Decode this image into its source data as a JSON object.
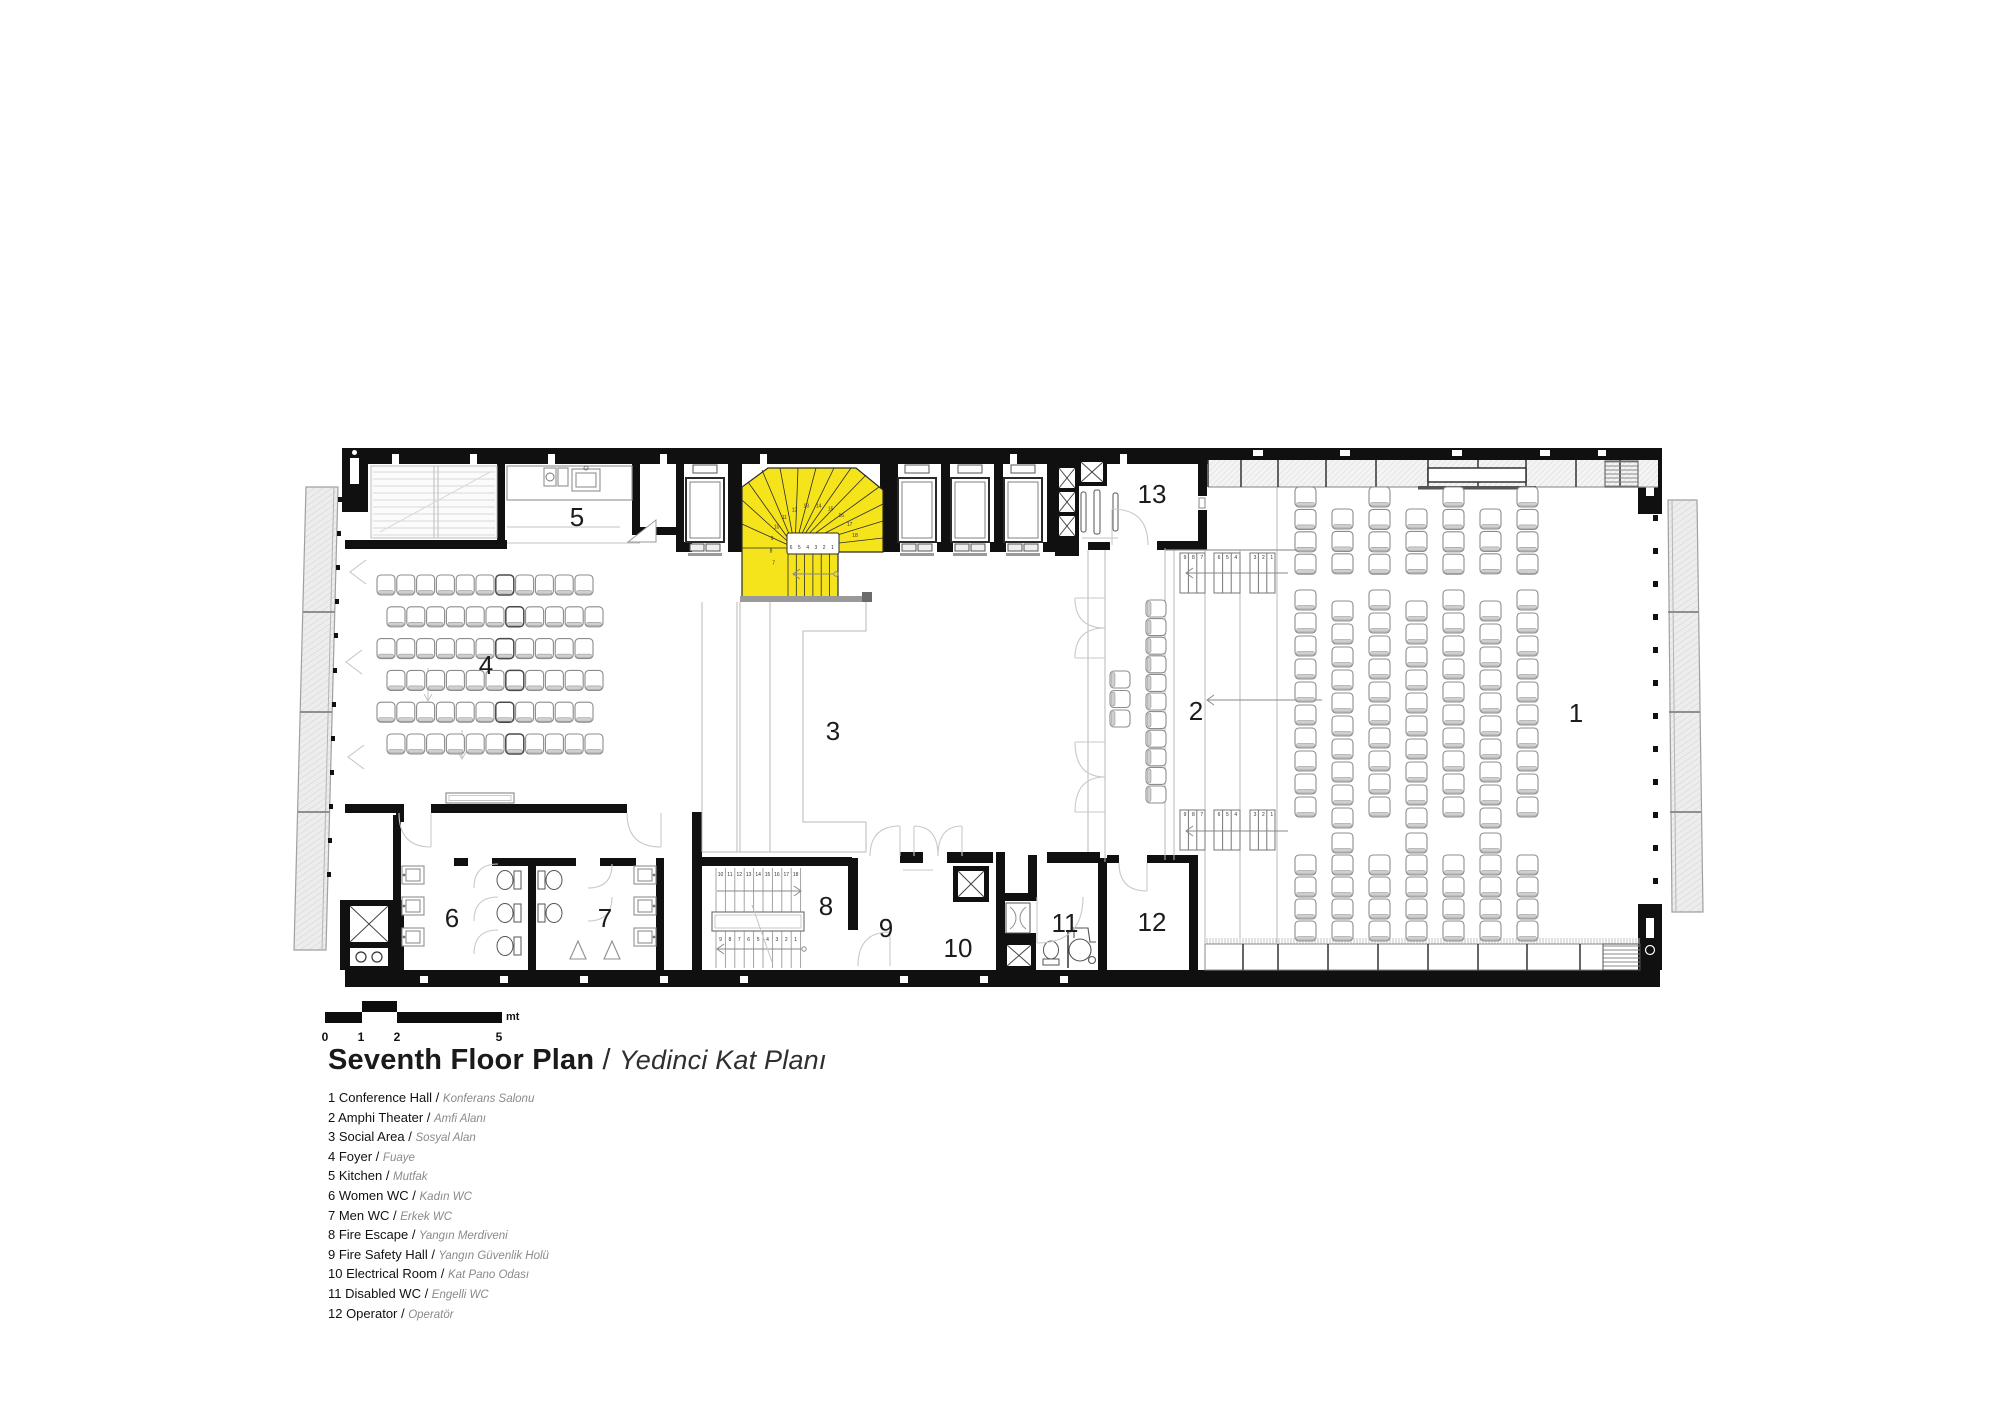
{
  "title": {
    "en": "Seventh Floor Plan",
    "sep": " / ",
    "tr": "Yedinci Kat Planı"
  },
  "legend": [
    {
      "num": "1",
      "en": "Conference Hall",
      "tr": "Konferans Salonu"
    },
    {
      "num": "2",
      "en": "Amphi Theater",
      "tr": "Amfi Alanı"
    },
    {
      "num": "3",
      "en": "Social Area",
      "tr": "Sosyal Alan"
    },
    {
      "num": "4",
      "en": "Foyer",
      "tr": "Fuaye"
    },
    {
      "num": "5",
      "en": "Kitchen",
      "tr": "Mutfak"
    },
    {
      "num": "6",
      "en": "Women WC",
      "tr": "Kadın WC"
    },
    {
      "num": "7",
      "en": "Men WC",
      "tr": "Erkek WC"
    },
    {
      "num": "8",
      "en": "Fire Escape",
      "tr": "Yangın Merdiveni"
    },
    {
      "num": "9",
      "en": "Fire Safety Hall",
      "tr": "Yangın Güvenlik Holü"
    },
    {
      "num": "10",
      "en": "Electrical Room",
      "tr": "Kat Pano Odası"
    },
    {
      "num": "11",
      "en": "Disabled WC",
      "tr": "Engelli  WC"
    },
    {
      "num": "12",
      "en": "Operator",
      "tr": "Operatör"
    }
  ],
  "scale_bar": {
    "ticks": [
      {
        "label": "0",
        "x": 0
      },
      {
        "label": "1",
        "x": 36
      },
      {
        "label": "2",
        "x": 72
      },
      {
        "label": "5",
        "x": 174
      }
    ],
    "unit": "mt"
  },
  "colors": {
    "stair_highlight": "#F5E41C",
    "wall": "#101010",
    "drawing_line": "#9a9a9a",
    "door_line": "#c9c9c9"
  },
  "plan": {
    "room_labels": [
      {
        "num": "1",
        "name": "conference-hall",
        "x": 1576,
        "y": 722
      },
      {
        "num": "2",
        "name": "amphi-theater",
        "x": 1196,
        "y": 720
      },
      {
        "num": "3",
        "name": "social-area",
        "x": 833,
        "y": 740
      },
      {
        "num": "4",
        "name": "foyer",
        "x": 486,
        "y": 674
      },
      {
        "num": "5",
        "name": "kitchen",
        "x": 577,
        "y": 526
      },
      {
        "num": "6",
        "name": "women-wc",
        "x": 452,
        "y": 927
      },
      {
        "num": "7",
        "name": "men-wc",
        "x": 605,
        "y": 927
      },
      {
        "num": "8",
        "name": "fire-escape",
        "x": 826,
        "y": 915
      },
      {
        "num": "9",
        "name": "fire-safety-hall",
        "x": 886,
        "y": 937
      },
      {
        "num": "10",
        "name": "electrical-room",
        "x": 958,
        "y": 957
      },
      {
        "num": "11",
        "name": "disabled-wc",
        "x": 1065,
        "y": 932
      },
      {
        "num": "12",
        "name": "operator",
        "x": 1152,
        "y": 931
      },
      {
        "num": "13",
        "name": "room-13",
        "x": 1152,
        "y": 503
      }
    ],
    "stair_main": {
      "fan_numbers": [
        "7",
        "8",
        "9",
        "10",
        "11",
        "12",
        "13",
        "14",
        "15",
        "16",
        "17",
        "18"
      ],
      "flight_numbers": [
        "6",
        "5",
        "4",
        "3",
        "2",
        "1"
      ]
    },
    "fire_stair": {
      "top_numbers": [
        "10",
        "11",
        "12",
        "13",
        "14",
        "15",
        "16",
        "17",
        "18"
      ],
      "bottom_numbers": [
        "9",
        "8",
        "7",
        "6",
        "5",
        "4",
        "3",
        "2",
        "1"
      ]
    },
    "amphi_steps": {
      "groups": [
        [
          "9",
          "8",
          "7"
        ],
        [
          "6",
          "5",
          "4"
        ],
        [
          "3",
          "2",
          "1"
        ]
      ]
    },
    "chair_groups": [
      {
        "name": "foyer-rows",
        "kind": "rows",
        "x": 377,
        "y": 575,
        "cols": 11,
        "rows": 6,
        "dx": 19.8,
        "dy": 31.8,
        "stagger": 10,
        "w": 18,
        "h": 20,
        "back": "bottom",
        "accent_col": 6
      },
      {
        "name": "hall-top",
        "kind": "cols",
        "x": 1295,
        "dx": 37,
        "cols": 7,
        "dy": 22.4,
        "w": 21,
        "h": 20,
        "back": "bottom",
        "even_y": 487,
        "even_n": 4,
        "odd_y": 509,
        "odd_n": 3
      },
      {
        "name": "hall-mid",
        "kind": "cols",
        "x": 1295,
        "dx": 37,
        "cols": 7,
        "dy": 23,
        "w": 21,
        "h": 20,
        "back": "bottom",
        "even_y": 590,
        "even_n": 10,
        "odd_y": 601,
        "odd_n": 10
      },
      {
        "name": "hall-bottom",
        "kind": "cols",
        "x": 1295,
        "dx": 37,
        "cols": 7,
        "dy": 22,
        "w": 21,
        "h": 20,
        "back": "bottom",
        "even_y": 855,
        "even_n": 4,
        "odd_y": 833,
        "odd_n": 5
      },
      {
        "name": "amphi-column",
        "kind": "rows",
        "x": 1146,
        "y": 600,
        "cols": 1,
        "rows": 11,
        "dx": 0,
        "dy": 18.6,
        "stagger": 0,
        "w": 20,
        "h": 17,
        "back": "left"
      },
      {
        "name": "amphi-cluster",
        "kind": "rows",
        "x": 1110,
        "y": 671,
        "cols": 1,
        "rows": 3,
        "dx": 0,
        "dy": 19.5,
        "stagger": 0,
        "w": 20,
        "h": 17,
        "back": "left"
      }
    ]
  }
}
